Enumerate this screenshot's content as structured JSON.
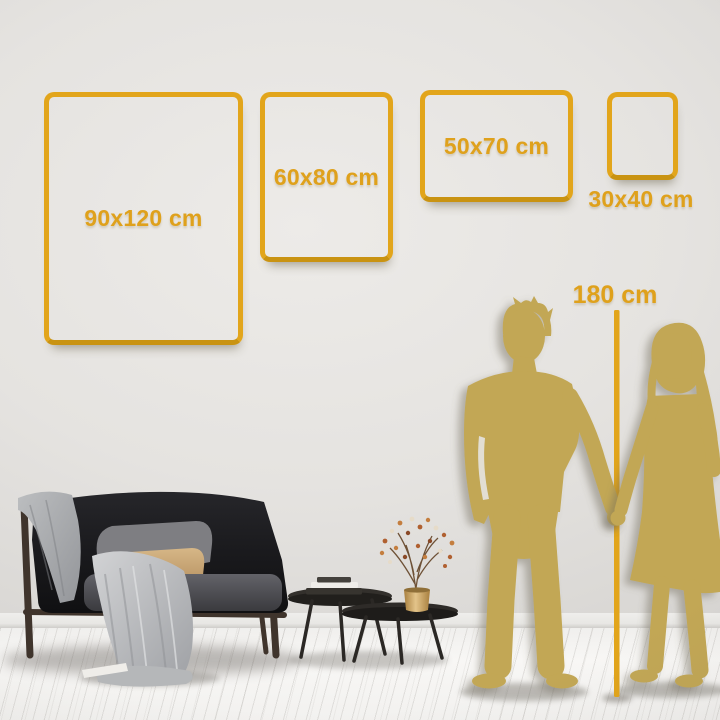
{
  "page": {
    "type": "wall-art-size-guide"
  },
  "colors": {
    "gold": "#e2a51b",
    "goldText": "#dfa11c",
    "silhouette": "#c2a754",
    "wall": "#e4e2df",
    "floor": "#f6f5f3"
  },
  "frames": [
    {
      "id": "90x120",
      "label": "90x120 cm",
      "label_position": "inside"
    },
    {
      "id": "60x80",
      "label": "60x80 cm",
      "label_position": "inside"
    },
    {
      "id": "50x70",
      "label": "50x70 cm",
      "label_position": "inside"
    },
    {
      "id": "30x40",
      "label": "30x40 cm",
      "label_position": "below"
    }
  ],
  "height_ruler": {
    "label": "180 cm"
  },
  "scene": {
    "items": [
      {
        "name": "sofa"
      },
      {
        "name": "throw-blanket"
      },
      {
        "name": "gray-pillow"
      },
      {
        "name": "tan-lumbar-pillow"
      },
      {
        "name": "nesting-coffee-tables"
      },
      {
        "name": "books"
      },
      {
        "name": "gold-vase-with-dried-branch"
      },
      {
        "name": "man-silhouette"
      },
      {
        "name": "woman-silhouette"
      }
    ]
  }
}
